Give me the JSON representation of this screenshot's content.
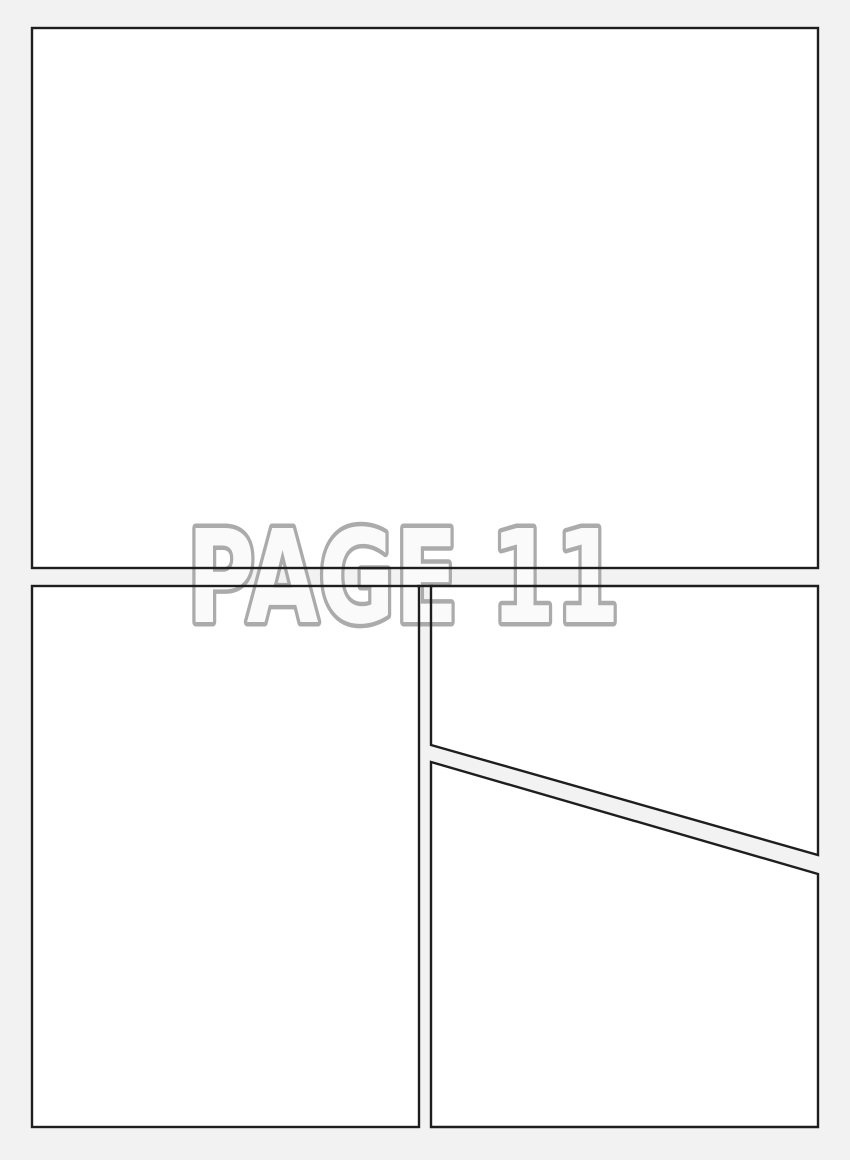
{
  "page": {
    "label": "PAGE 11"
  },
  "colors": {
    "canvas_bg": "#f2f2f2",
    "panel_fill": "#ffffff",
    "panel_border": "#1e1e1e",
    "label_fill": "#fafafa",
    "label_outline": "#ababab"
  },
  "panels": [
    {
      "name": "panel-1",
      "position": "top full-width"
    },
    {
      "name": "panel-2",
      "position": "bottom left"
    },
    {
      "name": "panel-3",
      "position": "bottom right upper (diagonal cut)"
    },
    {
      "name": "panel-4",
      "position": "bottom right lower (diagonal cut)"
    }
  ]
}
